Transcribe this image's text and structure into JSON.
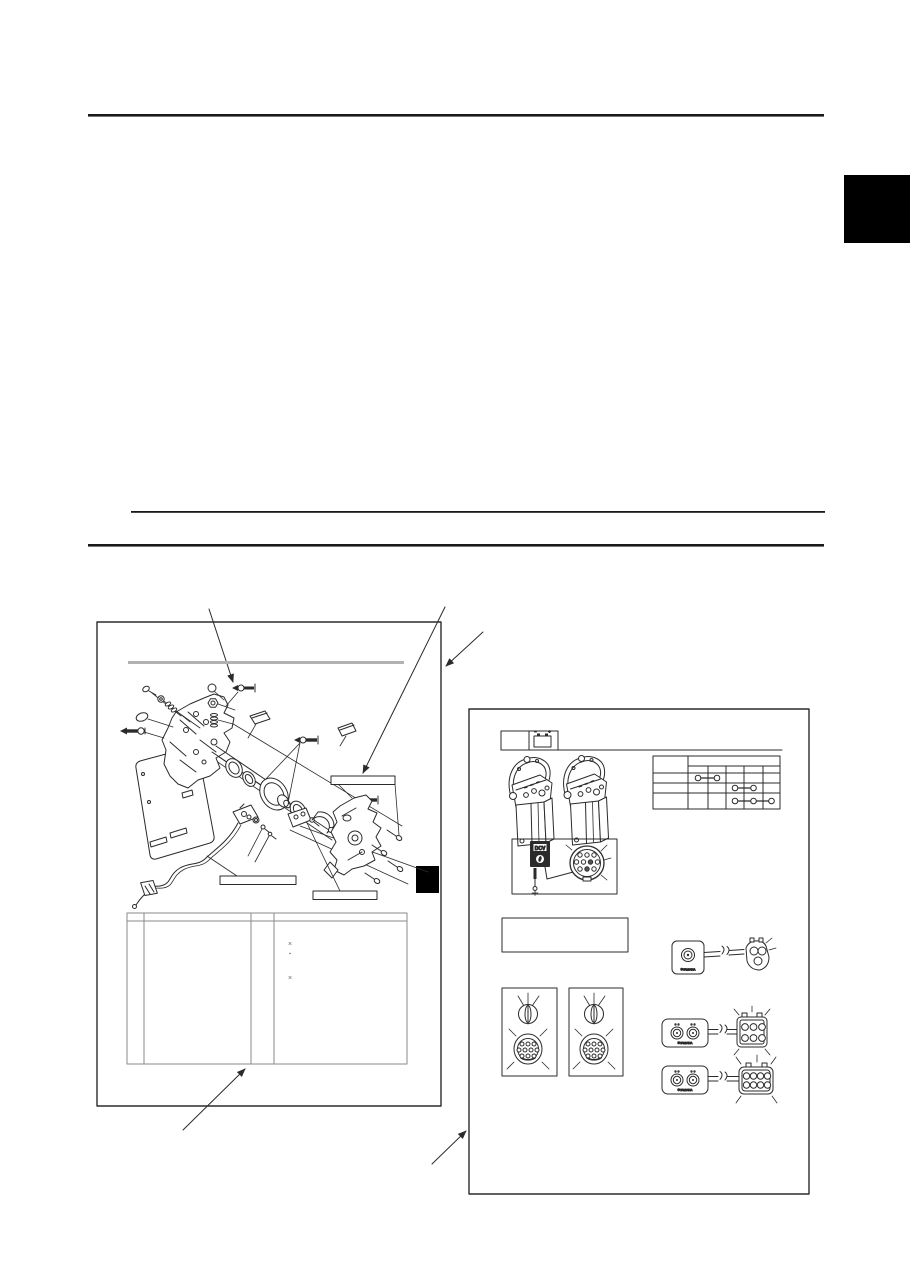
{
  "page": {
    "background": "#ffffff",
    "ink": "#2b2b2b",
    "rule_color": "#1a1a1a",
    "gray_bar_color": "#b2b2b2",
    "side_tab_color": "#000000",
    "table_line_color": "#8a8a8a",
    "highlight_square_color": "#000000"
  },
  "parts_figure": {
    "table_marks": [
      "×",
      "▪",
      "×"
    ]
  },
  "electrical_figure": {
    "meter_label": "DCV",
    "brand_mark": "©YAMAHA",
    "battery_negative_mark": "−",
    "battery_positive_mark": "+"
  }
}
